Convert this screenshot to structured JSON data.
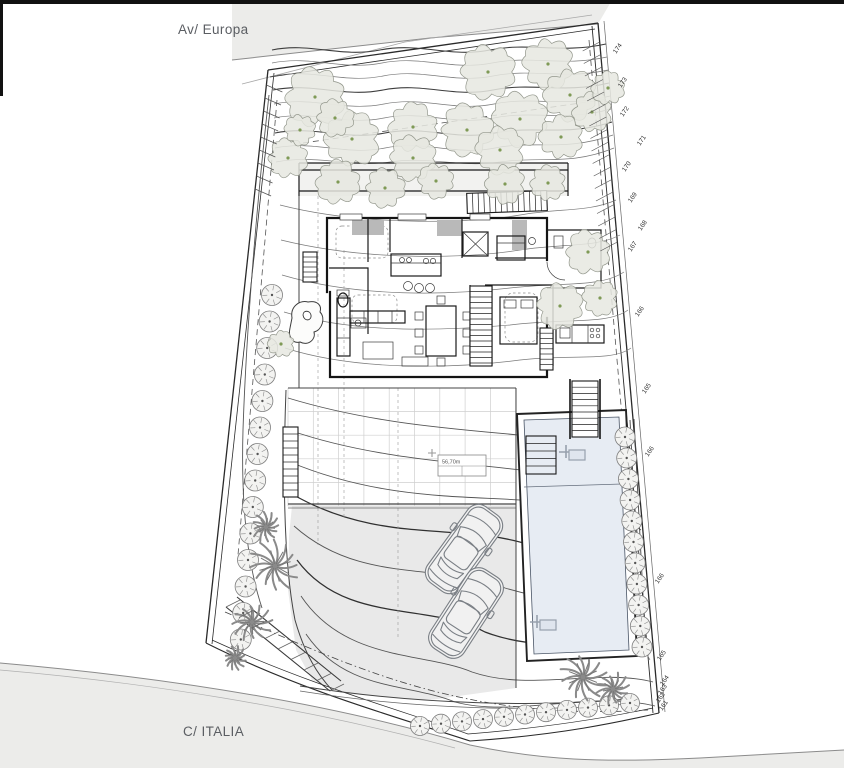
{
  "title": "Villa site plan",
  "streets": {
    "top": "Av/ Europa",
    "bottom": "C/ ITALIA"
  },
  "annotation": {
    "area_label": "56,70m"
  },
  "colors": {
    "street": "#ececea",
    "driveway": "#e9e9e9",
    "pool_water": "#e7ecf3",
    "tree_fill": "#e6e8e0",
    "tree_stroke": "#93978c",
    "palm": "#8a8a8a",
    "paper": "#ffffff",
    "line": "#2a2a2a"
  },
  "contour_labels": [
    {
      "t": "174",
      "x": 616,
      "y": 54
    },
    {
      "t": "173",
      "x": 621,
      "y": 88
    },
    {
      "t": "172",
      "x": 623,
      "y": 117
    },
    {
      "t": "171",
      "x": 640,
      "y": 146
    },
    {
      "t": "170",
      "x": 625,
      "y": 172
    },
    {
      "t": "169",
      "x": 631,
      "y": 203
    },
    {
      "t": "168",
      "x": 641,
      "y": 231
    },
    {
      "t": "167",
      "x": 631,
      "y": 252
    },
    {
      "t": "166",
      "x": 638,
      "y": 317
    },
    {
      "t": "165",
      "x": 645,
      "y": 394
    },
    {
      "t": "166",
      "x": 648,
      "y": 457
    },
    {
      "t": "166",
      "x": 658,
      "y": 584
    },
    {
      "t": "165",
      "x": 660,
      "y": 661
    },
    {
      "t": "164",
      "x": 663,
      "y": 686
    },
    {
      "t": "163",
      "x": 661,
      "y": 695
    },
    {
      "t": "162",
      "x": 659,
      "y": 703
    },
    {
      "t": "161",
      "x": 662,
      "y": 711
    }
  ],
  "trees": [
    [
      315,
      97,
      27
    ],
    [
      488,
      72,
      25
    ],
    [
      548,
      64,
      23
    ],
    [
      352,
      139,
      25
    ],
    [
      413,
      127,
      22
    ],
    [
      467,
      130,
      24
    ],
    [
      520,
      119,
      25
    ],
    [
      570,
      95,
      24
    ],
    [
      592,
      112,
      18
    ],
    [
      288,
      158,
      18
    ],
    [
      413,
      158,
      21
    ],
    [
      500,
      150,
      22
    ],
    [
      561,
      137,
      20
    ],
    [
      338,
      182,
      20
    ],
    [
      385,
      188,
      18
    ],
    [
      436,
      181,
      16
    ],
    [
      505,
      184,
      18
    ],
    [
      548,
      183,
      16
    ],
    [
      588,
      252,
      20
    ],
    [
      560,
      306,
      21
    ],
    [
      600,
      298,
      16
    ],
    [
      281,
      344,
      12
    ],
    [
      608,
      88,
      15
    ],
    [
      335,
      118,
      17
    ],
    [
      300,
      130,
      14
    ]
  ],
  "shrub_strips": [
    {
      "x": 272,
      "y": 295,
      "dx": -2.4,
      "dy": 26.5,
      "n": 14,
      "r": 10.5
    },
    {
      "x": 625,
      "y": 437,
      "dx": 1.7,
      "dy": 21,
      "n": 11,
      "r": 10
    },
    {
      "x": 420,
      "y": 726,
      "dx": 21,
      "dy": -2.3,
      "n": 11,
      "r": 9.5
    }
  ],
  "palms": [
    {
      "x": 275,
      "y": 566,
      "r": 27,
      "seed": 1
    },
    {
      "x": 252,
      "y": 622,
      "r": 20,
      "seed": 2
    },
    {
      "x": 266,
      "y": 527,
      "r": 15,
      "seed": 3
    },
    {
      "x": 583,
      "y": 677,
      "r": 25,
      "seed": 4
    },
    {
      "x": 613,
      "y": 689,
      "r": 17,
      "seed": 5
    },
    {
      "x": 235,
      "y": 658,
      "r": 12,
      "seed": 6
    }
  ],
  "cars": [
    {
      "x": 464,
      "y": 549,
      "rot": 36
    },
    {
      "x": 466,
      "y": 613,
      "rot": 33
    }
  ],
  "ladders": [
    {
      "x": 566,
      "y": 452
    },
    {
      "x": 537,
      "y": 622
    }
  ],
  "stairs": [
    {
      "x": 467,
      "y": 192,
      "w": 80,
      "h": 20,
      "dir": "v",
      "step": 5.7,
      "rot": -2
    },
    {
      "x": 470,
      "y": 286,
      "w": 22,
      "h": 80,
      "dir": "h",
      "step": 5.5
    },
    {
      "x": 303,
      "y": 252,
      "w": 14,
      "h": 30,
      "dir": "h",
      "step": 5
    },
    {
      "x": 283,
      "y": 427,
      "w": 15,
      "h": 70,
      "dir": "h",
      "step": 7
    },
    {
      "x": 572,
      "y": 381,
      "w": 26,
      "h": 56,
      "dir": "h",
      "step": 6.2
    },
    {
      "x": 540,
      "y": 328,
      "w": 13,
      "h": 42,
      "dir": "h",
      "step": 5.2
    },
    {
      "x": 526,
      "y": 436,
      "w": 30,
      "h": 38,
      "dir": "h",
      "step": 7.5,
      "nofill": true
    }
  ]
}
